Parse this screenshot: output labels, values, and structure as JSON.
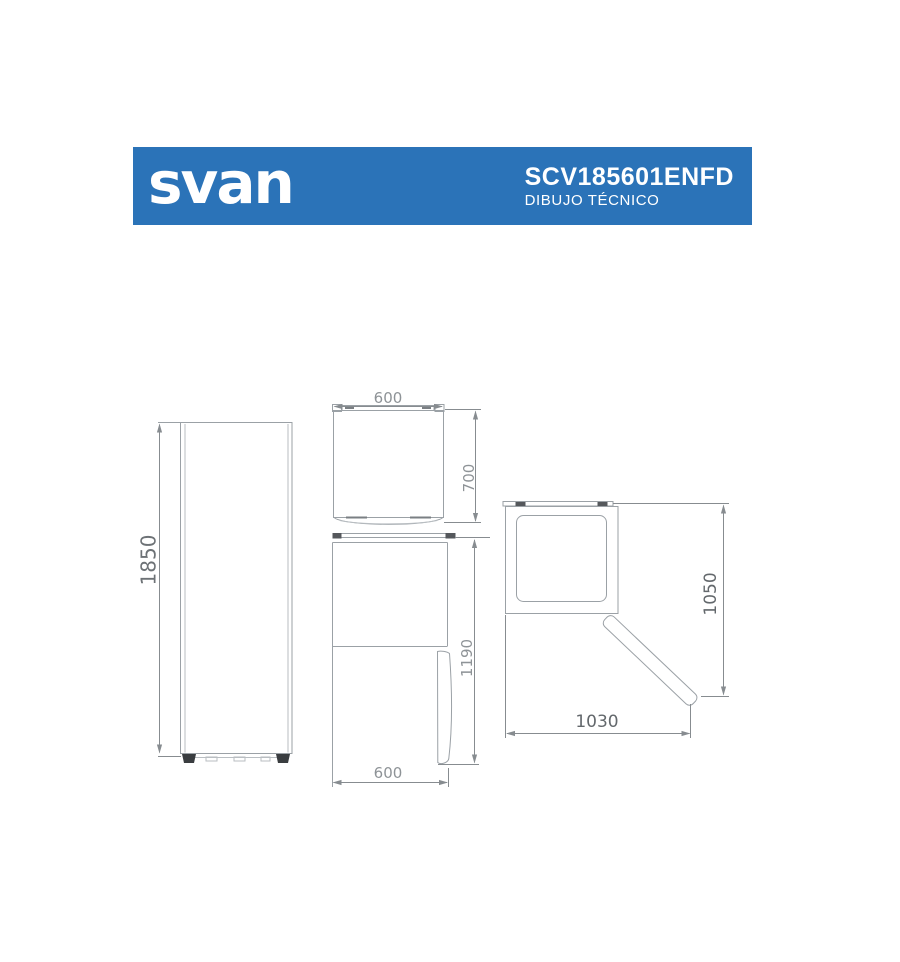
{
  "header": {
    "logo": "svan",
    "model": "SCV185601ENFD",
    "subtitle": "DIBUJO TÉCNICO",
    "colors": {
      "background": "#2b73b8",
      "text": "#ffffff"
    }
  },
  "drawing": {
    "colors": {
      "line": "#9ba1a6",
      "dimension": "#878c90",
      "dim_text": "#8e9397",
      "dim_text_dark": "#6d7276"
    },
    "front_view": {
      "height": "1850"
    },
    "top_view": {
      "width": "600",
      "depth": "700"
    },
    "side_view": {
      "height": "1190",
      "depth": "600"
    },
    "door_open_view": {
      "width": "1030",
      "depth": "1050"
    }
  }
}
